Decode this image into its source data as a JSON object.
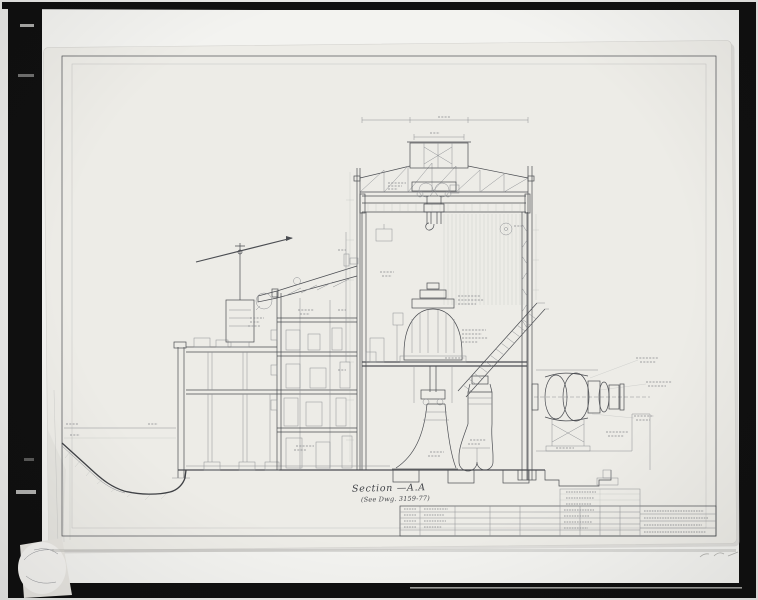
{
  "photo": {
    "colors": {
      "scan_background": "#e9e9e7",
      "film_border": "#101010",
      "photo_paper": "#f3f3f0",
      "sheet_paper": "#edece7",
      "ink": "#4b4d52",
      "faint_ink": "#8e9094",
      "pencil": "#a0a09c"
    }
  },
  "drawing": {
    "caption_title": "Section —A.A",
    "caption_subtitle": "(See Dwg. 3159-77)"
  }
}
